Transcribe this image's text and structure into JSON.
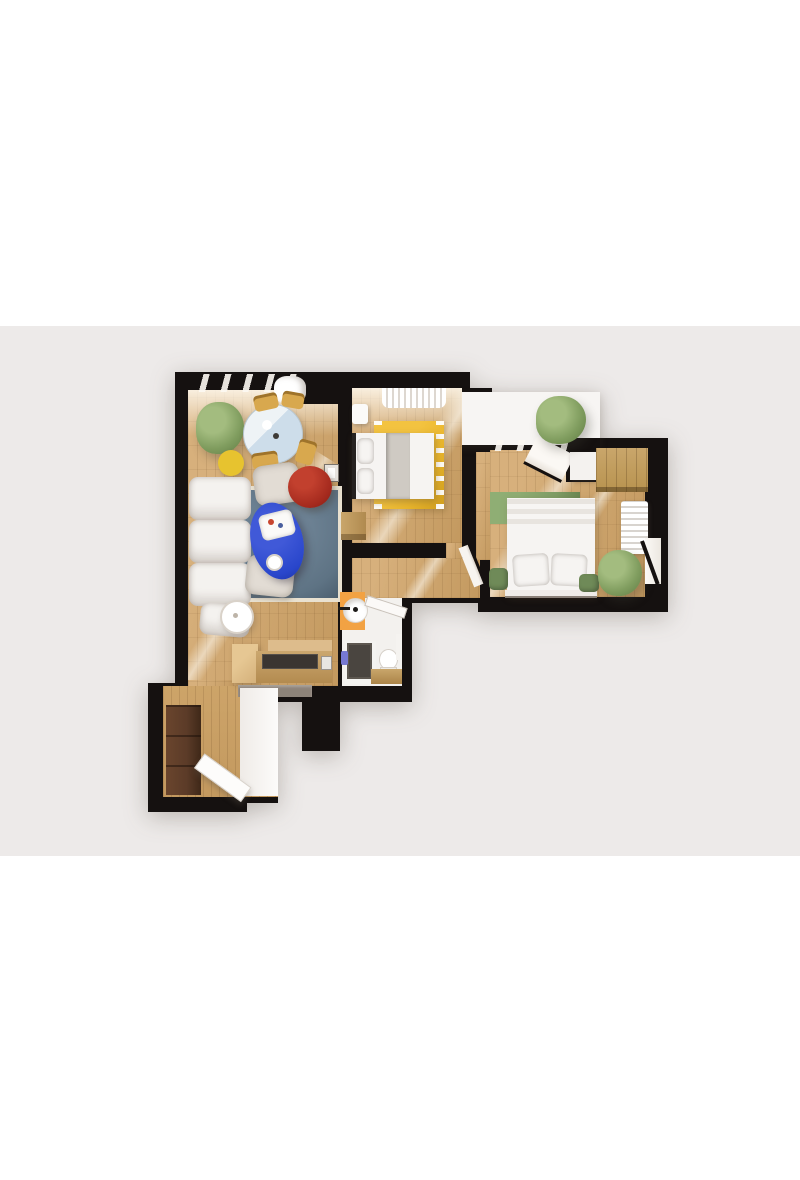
{
  "image": {
    "type": "3d-floor-plan-top-view-render",
    "description": "Photorealistic top-down 3D render of a two-bedroom apartment floor plan centered on a light warm-gray backdrop with white bands above and below; no text or UI controls are visible"
  },
  "colors": {
    "background_top": "#ffffff",
    "background_photo": "#edeae9",
    "wall": "#151110",
    "wood": "#d7b07c",
    "wood_dark": "#c3995f",
    "wood_entry": "#cda469",
    "balcony_floor": "#f7f5f3",
    "bath_floor": "#f3f1ee",
    "rug_living": "#5e7384",
    "rug_living_border": "#e9e1d0",
    "rug_yellow": "#e9b52b",
    "rug_green": "#7e9d65",
    "table_blue_top": "#cdddea",
    "chair_wood": "#d8a84e",
    "side_table_yellow": "#e7c32f",
    "pouf_red": "#a3291d",
    "coffee_table_blue": "#2946cb",
    "sofa_white": "#f4f2ef",
    "armchair_beige": "#e2dcd4",
    "bed_white": "#f6f4f2",
    "blanket_gray": "#cfcac3",
    "wardrobe_wood": "#c9a66b",
    "wardrobe_brown": "#5b3b28",
    "counter_top_dark": "#3a3531",
    "pass_gray": "#8d8379",
    "bath_accent_orange": "#f2a243",
    "shower_tray": "#4a4540",
    "towel_blue": "#7678d2",
    "plant_green": "#7f9c5e",
    "plant_green_light": "#a3bc7f",
    "radiator_white": "#f1efec",
    "pouf_green": "#6f8a58",
    "window_glow": "#fdf9f3"
  },
  "floor_plan": {
    "rooms": [
      {
        "name": "living-room",
        "key_items": [
          "window-wall-with-curtain",
          "potted-plant",
          "round-dining-table",
          "four-wood-chairs",
          "yellow-side-table",
          "white-sectional-sofa",
          "two-beige-armchairs",
          "red-pouf",
          "blue-oval-coffee-table",
          "blue-gray-area-rug",
          "floor-lamp",
          "wall-intercom"
        ]
      },
      {
        "name": "bedroom-1",
        "key_items": [
          "window-curtain",
          "double-bed-white",
          "yellow-fringed-rug",
          "nightstand",
          "wood-dresser",
          "sunlight-streak"
        ]
      },
      {
        "name": "bedroom-2",
        "key_items": [
          "balcony-window-band",
          "open-window-pane",
          "wardrobe",
          "double-bed-white",
          "green-rug",
          "two-green-poufs",
          "radiator",
          "potted-plant",
          "side-window"
        ]
      },
      {
        "name": "bathroom",
        "key_items": [
          "orange-vanity-panel",
          "round-basin",
          "open-door",
          "shower-cabin",
          "blue-towel",
          "toilet",
          "wood-counter"
        ]
      },
      {
        "name": "kitchen-nook",
        "key_items": [
          "l-shaped-counter",
          "dark-cooktop",
          "upper-cabinet",
          "gray-pass-wall"
        ]
      },
      {
        "name": "entry-hall",
        "key_items": [
          "brown-wardrobe",
          "open-entry-door",
          "white-lit-floor"
        ]
      },
      {
        "name": "balcony",
        "key_items": [
          "white-terrace-floor",
          "potted-plant"
        ]
      }
    ]
  }
}
